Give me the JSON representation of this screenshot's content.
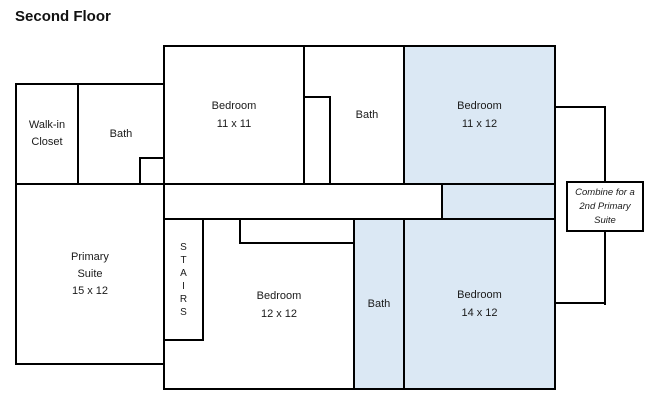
{
  "title": "Second Floor",
  "colors": {
    "highlight": "#dbe8f4",
    "wall": "#000000",
    "background": "#ffffff",
    "text": "#1a1a1a"
  },
  "rooms": {
    "walk_in_closet": {
      "line1": "Walk-in",
      "line2": "Closet"
    },
    "bath_upper_left": {
      "label": "Bath"
    },
    "bedroom_11x11": {
      "line1": "Bedroom",
      "line2": "11 x 11"
    },
    "bath_upper": {
      "label": "Bath"
    },
    "bedroom_11x12": {
      "line1": "Bedroom",
      "line2": "11 x 12",
      "highlighted": true
    },
    "primary_suite": {
      "line1": "Primary",
      "line2": "Suite",
      "line3": "15 x 12"
    },
    "stairs": {
      "letters": [
        "S",
        "T",
        "A",
        "I",
        "R",
        "S"
      ]
    },
    "bedroom_12x12": {
      "line1": "Bedroom",
      "line2": "12 x 12"
    },
    "bath_lower": {
      "label": "Bath",
      "highlighted": true
    },
    "bedroom_14x12": {
      "line1": "Bedroom",
      "line2": "14 x 12",
      "highlighted": true
    }
  },
  "annotation": {
    "line1": "Combine for a",
    "line2": "2nd Primary",
    "line3": "Suite"
  }
}
